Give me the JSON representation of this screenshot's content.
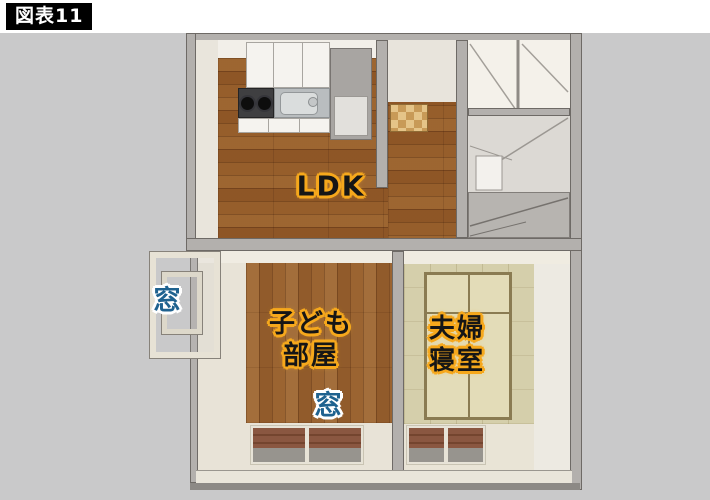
{
  "figure": {
    "label": "図表11"
  },
  "floorplan": {
    "type": "apartment-3d-floorplan",
    "rooms": [
      {
        "id": "ldk",
        "label": "LDK",
        "floor": "wood"
      },
      {
        "id": "kids-room",
        "label": "子ども部屋",
        "label_lines": [
          "子ども",
          "部屋"
        ],
        "floor": "wood"
      },
      {
        "id": "master-bedroom",
        "label": "夫婦寝室",
        "label_lines": [
          "夫婦",
          "寝室"
        ],
        "floor": "tatami"
      }
    ],
    "window_labels": [
      {
        "id": "window-left",
        "label": "窓"
      },
      {
        "id": "window-south",
        "label": "窓"
      }
    ],
    "colors": {
      "page_background": "#c9c9ca",
      "header_background": "#ffffff",
      "figure_label_background": "#000000",
      "figure_label_text": "#ffffff",
      "room_label_text": "#161616",
      "room_label_outline": "#f6a81c",
      "window_label_text": "#1f628f",
      "window_label_outline": "#ffffff",
      "wall": "#b3b0ad",
      "wood_floor": "#c39a68",
      "tatami_floor": "#d5cfab"
    }
  }
}
